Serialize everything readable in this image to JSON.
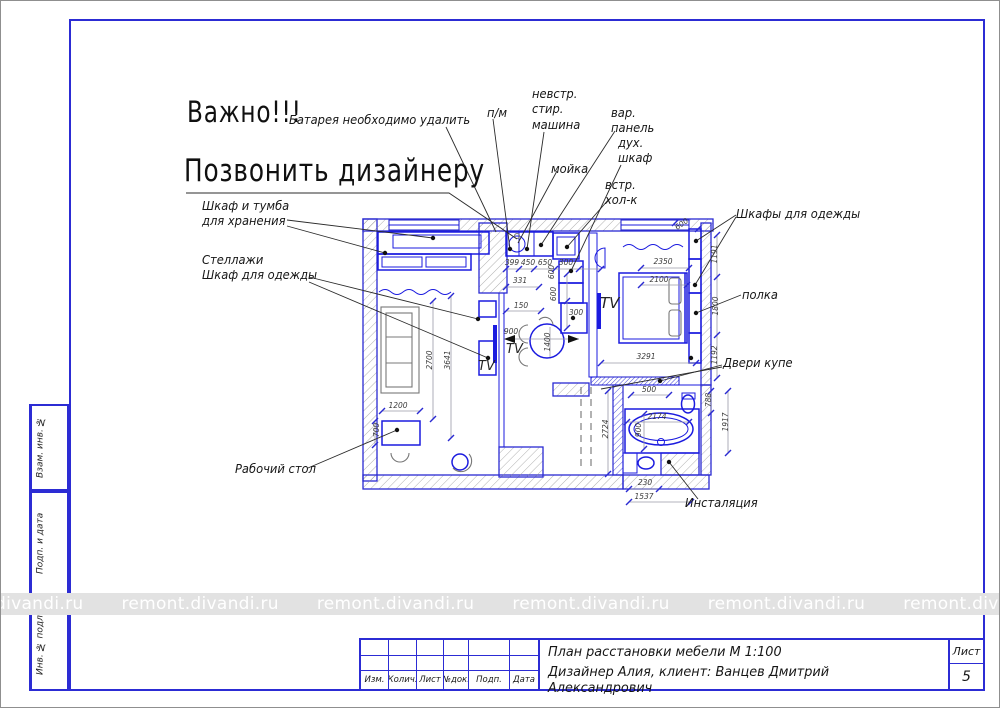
{
  "notes": {
    "important": "Важно!!!",
    "call_designer": "Позвонить дизайнеру"
  },
  "margin_boxes": [
    {
      "label": "Взам. инв. №"
    },
    {
      "label": "Подп. и дата"
    },
    {
      "label": "Инв. № подл."
    }
  ],
  "watermark": {
    "text": "remont.divandi.ru",
    "repeat": 8
  },
  "title_block": {
    "doc_title": "План расстановки мебели М 1:100",
    "doc_subtitle": "Дизайнер Алия, клиент: Ванцев Дмитрий Александрович",
    "columns": [
      "Изм.",
      "Колич.",
      "Лист",
      "№док.",
      "Подп.",
      "Дата"
    ],
    "sheet_label": "Лист",
    "sheet_number": "5"
  },
  "callouts": [
    {
      "id": "battery",
      "text": "Батарея необходимо удалить",
      "x": 288,
      "y": 111,
      "fs": 12.5
    },
    {
      "id": "pm",
      "text": "п/м",
      "x": 486,
      "y": 104,
      "fs": 12.5
    },
    {
      "id": "washer",
      "text": "невстр.\nстир.\nмашина",
      "x": 531,
      "y": 85,
      "fs": 12.5
    },
    {
      "id": "sink",
      "text": "мойка",
      "x": 550,
      "y": 160,
      "fs": 12.5
    },
    {
      "id": "cooktop",
      "text": "вар.\nпанель",
      "x": 610,
      "y": 104,
      "fs": 12.5
    },
    {
      "id": "oven",
      "text": "дух.\nшкаф",
      "x": 617,
      "y": 134,
      "fs": 12.5
    },
    {
      "id": "fridge",
      "text": "встр.\nхол-к",
      "x": 604,
      "y": 176,
      "fs": 12.5
    },
    {
      "id": "wardrobes",
      "text": "Шкафы для одежды",
      "x": 735,
      "y": 205,
      "fs": 12.5
    },
    {
      "id": "shelf",
      "text": "полка",
      "x": 741,
      "y": 286,
      "fs": 12.5
    },
    {
      "id": "sliding-doors",
      "text": "Двери купе",
      "x": 722,
      "y": 354,
      "fs": 12.5
    },
    {
      "id": "cabinet",
      "text": "Шкаф и тумба\nдля хранения",
      "x": 201,
      "y": 197,
      "fs": 12.5
    },
    {
      "id": "shelving",
      "text": "Стеллажи\nШкаф для одежды",
      "x": 201,
      "y": 251,
      "fs": 12.5
    },
    {
      "id": "desk",
      "text": "Рабочий стол",
      "x": 234,
      "y": 460,
      "fs": 12.5
    },
    {
      "id": "installation",
      "text": "Инсталяция",
      "x": 684,
      "y": 494,
      "fs": 12.5
    }
  ],
  "plan": {
    "tv_labels": [
      {
        "text": "TV",
        "x": 505,
        "y": 352,
        "fs": 13
      },
      {
        "text": "TV",
        "x": 477,
        "y": 369,
        "fs": 13
      },
      {
        "text": "TV",
        "x": 599,
        "y": 307,
        "fs": 15
      }
    ],
    "dimensions": [
      {
        "t": "399",
        "x": 511,
        "y": 264,
        "r": 0
      },
      {
        "t": "450",
        "x": 527,
        "y": 264,
        "r": 0
      },
      {
        "t": "650",
        "x": 544,
        "y": 264,
        "r": 0
      },
      {
        "t": "300",
        "x": 565,
        "y": 264,
        "r": 0
      },
      {
        "t": "331",
        "x": 519,
        "y": 282,
        "r": 0
      },
      {
        "t": "150",
        "x": 520,
        "y": 307,
        "r": 0
      },
      {
        "t": "600",
        "x": 553,
        "y": 271,
        "r": -90
      },
      {
        "t": "600",
        "x": 555,
        "y": 293,
        "r": -90
      },
      {
        "t": "300",
        "x": 575,
        "y": 314,
        "r": 0
      },
      {
        "t": "900",
        "x": 510,
        "y": 333,
        "r": 0
      },
      {
        "t": "1400",
        "x": 549,
        "y": 341,
        "r": -90
      },
      {
        "t": "2350",
        "x": 662,
        "y": 263,
        "r": 0
      },
      {
        "t": "2100",
        "x": 658,
        "y": 281,
        "r": 0
      },
      {
        "t": "3291",
        "x": 645,
        "y": 358,
        "r": 0
      },
      {
        "t": "600",
        "x": 682,
        "y": 225,
        "r": -35
      },
      {
        "t": "1191",
        "x": 716,
        "y": 253,
        "r": -90
      },
      {
        "t": "1800",
        "x": 717,
        "y": 305,
        "r": -90
      },
      {
        "t": "1192",
        "x": 716,
        "y": 354,
        "r": -90
      },
      {
        "t": "788",
        "x": 710,
        "y": 399,
        "r": -90
      },
      {
        "t": "1917",
        "x": 727,
        "y": 421,
        "r": -90
      },
      {
        "t": "500",
        "x": 648,
        "y": 391,
        "r": 0
      },
      {
        "t": "2174",
        "x": 656,
        "y": 418,
        "r": 0
      },
      {
        "t": "900",
        "x": 640,
        "y": 429,
        "r": -90
      },
      {
        "t": "2724",
        "x": 607,
        "y": 428,
        "r": -90
      },
      {
        "t": "230",
        "x": 644,
        "y": 484,
        "r": 0
      },
      {
        "t": "1537",
        "x": 643,
        "y": 498,
        "r": 0
      },
      {
        "t": "2700",
        "x": 431,
        "y": 359,
        "r": -90
      },
      {
        "t": "3641",
        "x": 449,
        "y": 359,
        "r": -90
      },
      {
        "t": "1200",
        "x": 397,
        "y": 407,
        "r": 0
      },
      {
        "t": "700",
        "x": 378,
        "y": 429,
        "r": -90
      }
    ]
  }
}
